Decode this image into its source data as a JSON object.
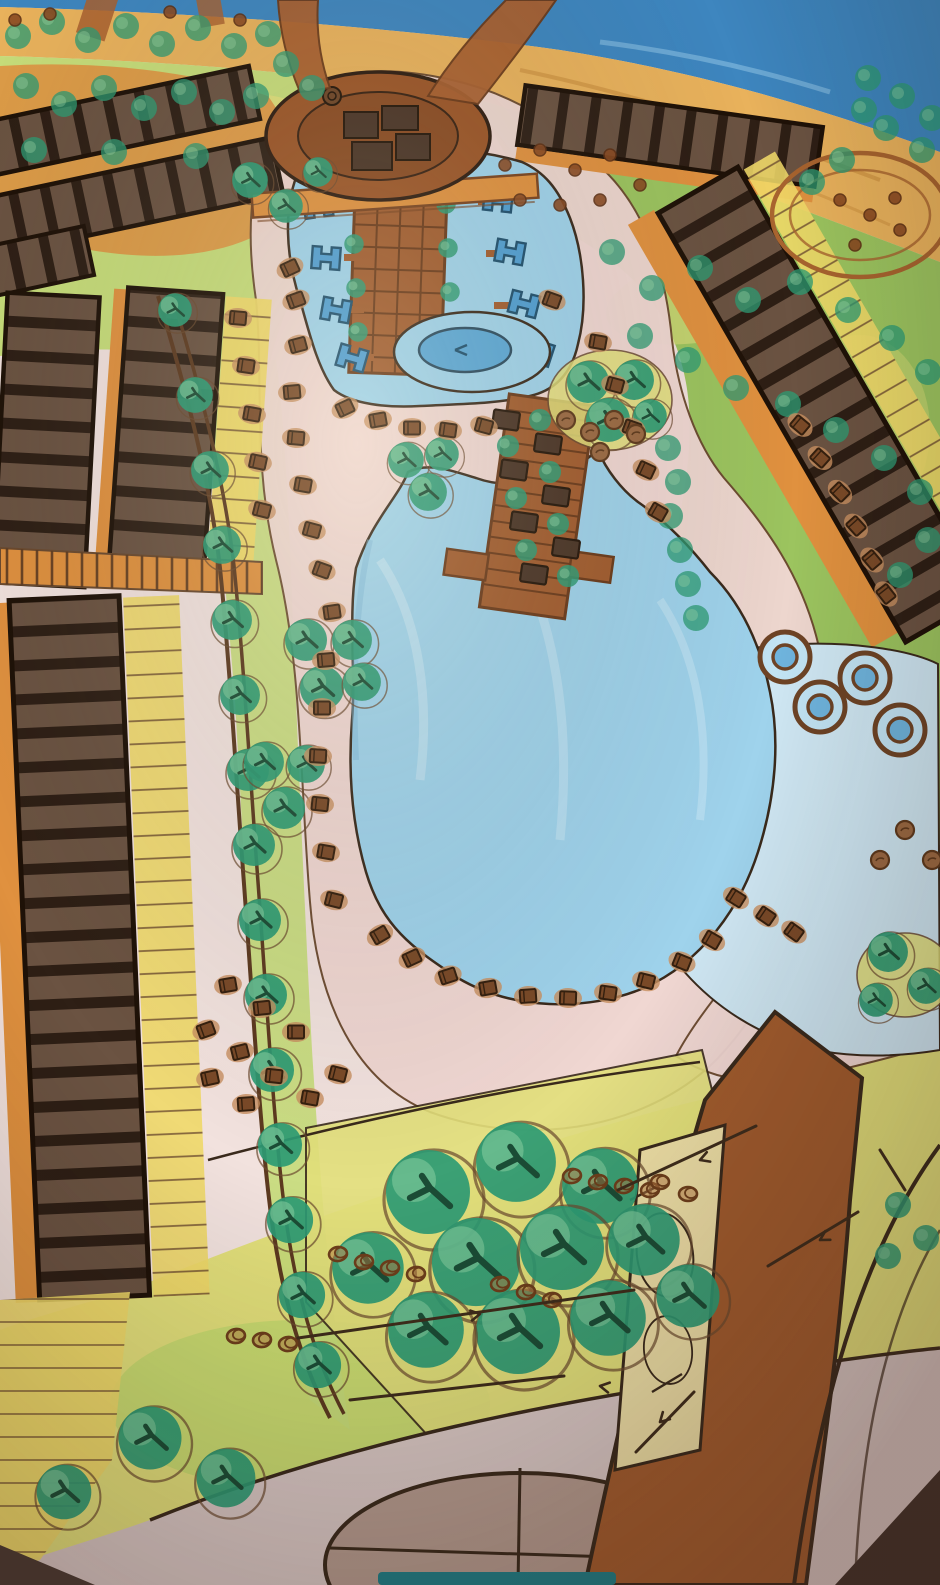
{
  "scene": {
    "title": "Hand-drawn resort master plan sketch",
    "medium": "marker and watercolor on paper, photographed at an angle",
    "view": "aerial site plan",
    "visible_text": "none"
  },
  "palette": {
    "paper": "#f2e2de",
    "sea": "#3e86bf",
    "sea_light": "#7fb7dd",
    "sand": "#e9b25c",
    "lawn": "#9cc45f",
    "lawn_light": "#c7dd7a",
    "lawn_yellow": "#e3e07b",
    "deck_pink": "#f0d7d2",
    "pool_blue": "#9fd3ec",
    "pool_deep": "#5aa8d8",
    "pool_shallow": "#cfe7f3",
    "cabana_blue": "#4f9fd4",
    "board_brown": "#a25c2e",
    "board_line": "#6b3a1a",
    "building_brown": "#9c5527",
    "building_dark": "#4a3426",
    "block_fill": "#6b5342",
    "block_stripe": "#2e1f15",
    "path_orange": "#e0913f",
    "yellow_strip": "#f0d969",
    "tree_green": "#2e9b74",
    "tree_light": "#7cc79a",
    "lounger_brown": "#7a4a28",
    "lounger_tan": "#c89060",
    "rock_brown": "#9c6a43",
    "ink": "#3a2a1c",
    "road_light": "#d8c7c4",
    "plaza_gray": "#b49a8e",
    "bottom_teal": "#1f7d86"
  },
  "features": [
    {
      "id": "sea",
      "label": "sea"
    },
    {
      "id": "beach",
      "label": "sandy beach with umbrella dots"
    },
    {
      "id": "main-building",
      "label": "oval entrance building"
    },
    {
      "id": "entry-bridge",
      "label": "orange footbridge"
    },
    {
      "id": "upper-pool",
      "label": "upper pool with water cabanas"
    },
    {
      "id": "central-boardwalk",
      "label": "plank boardwalk with pavilions"
    },
    {
      "id": "fountain-pool",
      "label": "round island pool"
    },
    {
      "id": "main-lagoon-pool",
      "label": "large lagoon pool"
    },
    {
      "id": "shallow-pool",
      "label": "shallow pool with spa circles"
    },
    {
      "id": "villa-blocks",
      "label": "striped accommodation blocks"
    },
    {
      "id": "tree-lined-avenue",
      "label": "tree-lined avenue"
    },
    {
      "id": "sun-loungers",
      "label": "sun lounger groups"
    },
    {
      "id": "garden-grove",
      "label": "south garden grove"
    },
    {
      "id": "access-road",
      "label": "brown access road"
    },
    {
      "id": "south-road",
      "label": "curved south road with plaza"
    }
  ],
  "counts": {
    "villa_blocks": 6,
    "spa_circles": 4,
    "water_cabanas": 8,
    "boardwalk_pavilions": 9
  }
}
